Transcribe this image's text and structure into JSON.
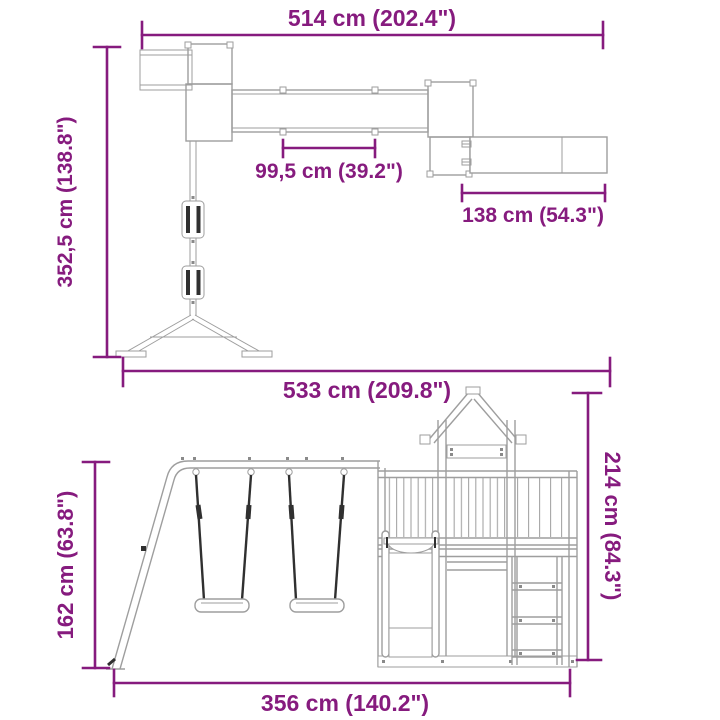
{
  "colors": {
    "dimension": "#861b7e",
    "structure": "#9e9e9e",
    "dark_detail": "#303030",
    "background": "#ffffff"
  },
  "diagrams": {
    "top": {
      "view": "plan view of play structure with bridge and slide",
      "dims": {
        "overall_width": "514 cm (202.4\")",
        "bridge_section": "99,5 cm (39.2\")",
        "slide_length": "138 cm (54.3\")",
        "overall_depth": "352,5 cm (138.8\")"
      }
    },
    "bottom": {
      "view": "front view of swing set with tower, slide and ladder",
      "dims": {
        "overall_width": "533 cm (209.8\")",
        "overall_height": "214 cm (84.3\")",
        "swing_frame_height": "162 cm (63.8\")",
        "base_width": "356 cm (140.2\")"
      }
    }
  }
}
